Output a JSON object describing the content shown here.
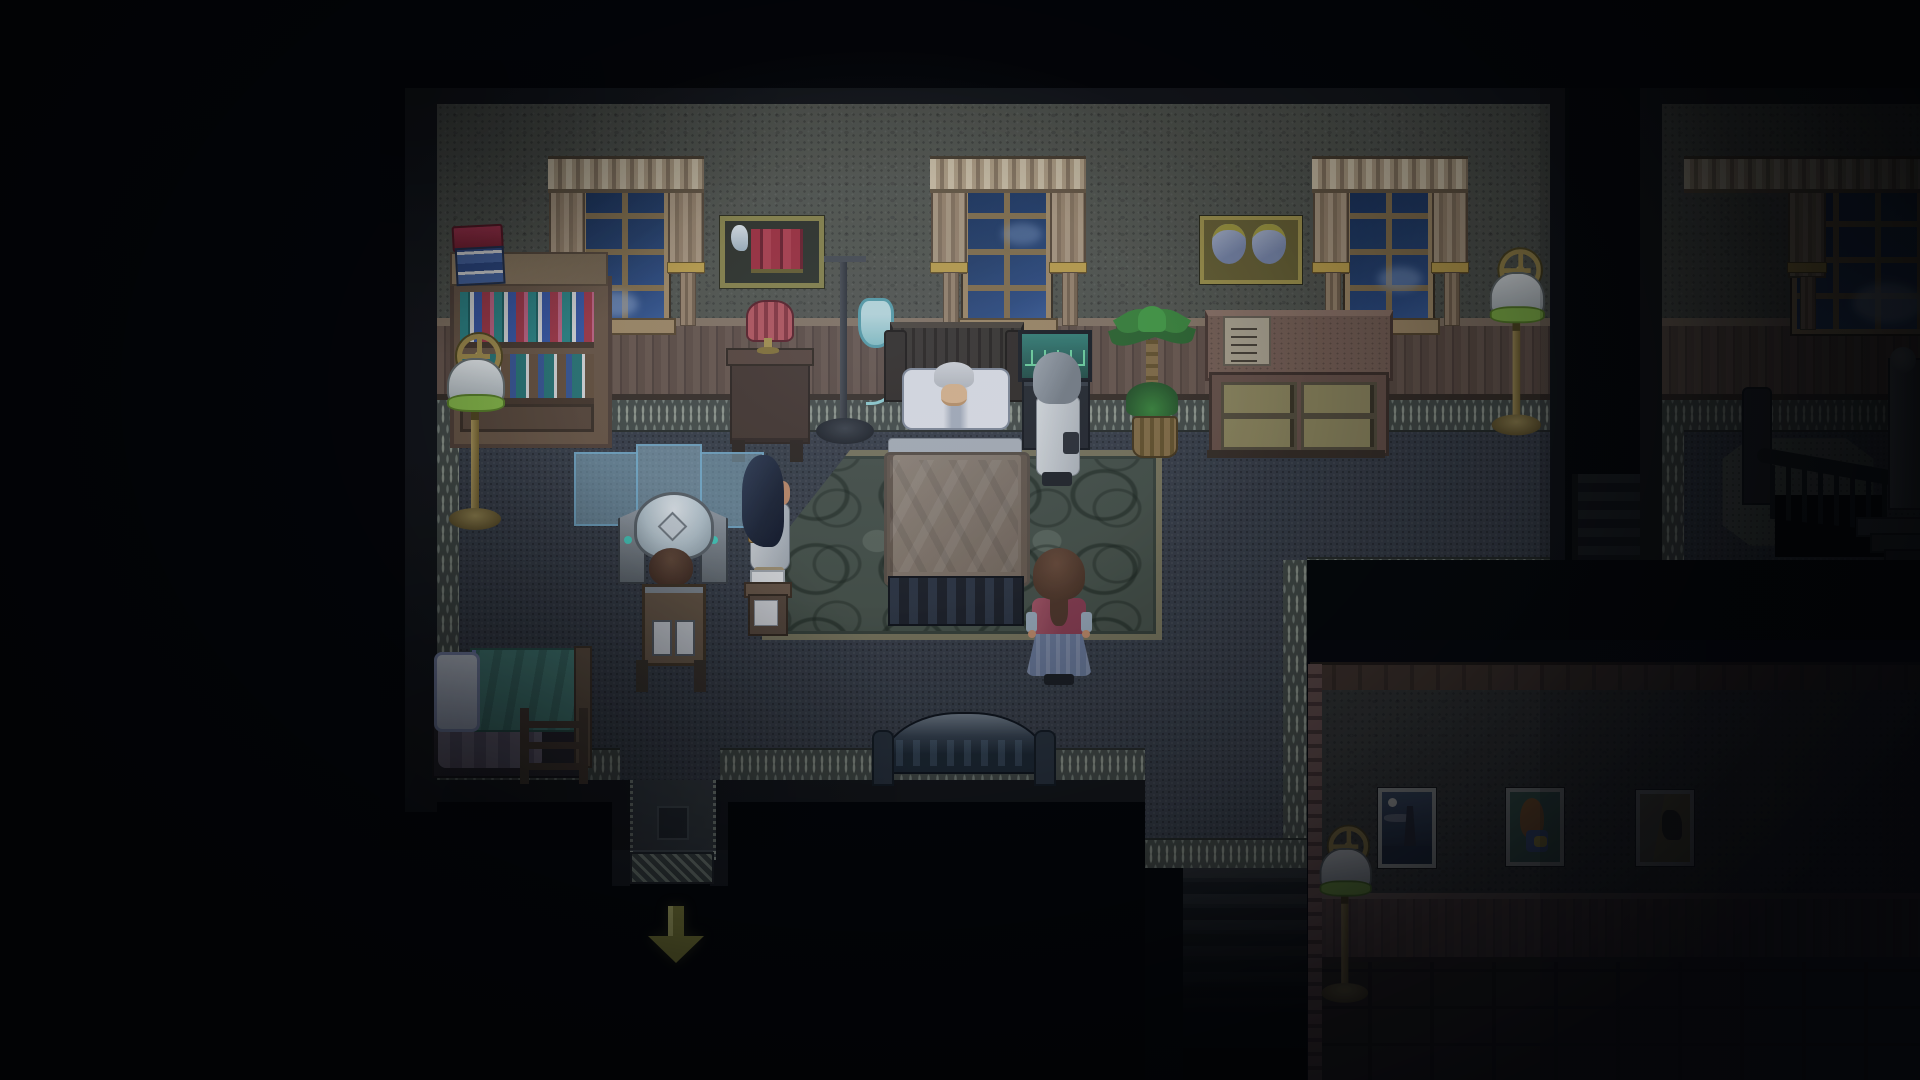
{
  "meta": {
    "domain": "game",
    "style": "16-bit pixel RPG interior",
    "time_of_day": "night",
    "ui_text_visible": false
  },
  "palette": {
    "background": "#030507",
    "stone_wall": "#565951",
    "wainscot": "#6e5b50",
    "floor": "#3b414b",
    "floor_border_dots": "#98a094",
    "window_glass": "#24406e",
    "window_frame": "#a8906a",
    "curtain": "#b4a086",
    "rug_green": "#49544b",
    "lamp_shade": "#f0f4f5",
    "lamp_rim_green": "#8cc04a",
    "brass": "#9a8650",
    "blanket": "#8a7d70",
    "monitor_screen": "#2e6a64",
    "monitor_wave": "#74e0a8",
    "iv_bag": "#8ecfd4",
    "red_lamp": "#b85058",
    "exit_arrow_olive": "#8a8a3c",
    "hall_wainscot": "#72594f"
  },
  "scene": {
    "rooms": [
      {
        "id": "bedroom",
        "label": "main bedroom with three windows",
        "window_count": 3
      },
      {
        "id": "landing",
        "label": "stair landing room with one window and spiral staircase",
        "window_count": 1
      },
      {
        "id": "hallway",
        "label": "lower hallway with three paintings",
        "painting_count": 3
      }
    ],
    "characters": [
      {
        "id": "patient",
        "label": "elderly patient with white hair lying in the sickbed",
        "hair": "white"
      },
      {
        "id": "woman_white_dress",
        "label": "woman with long dark navy hair in a white dress standing left of the bed",
        "hair": "dark navy"
      },
      {
        "id": "caretaker",
        "label": "grey haired person in a white coat standing right of the bed",
        "hair": "grey"
      },
      {
        "id": "girl",
        "label": "brown haired girl in dark pink top and long blue skirt facing the bed",
        "hair": "brown"
      },
      {
        "id": "operator",
        "label": "brown haired person seated at the memory machine",
        "hair": "brown"
      }
    ],
    "furniture": [
      {
        "id": "sickbed",
        "label": "dark wooden sickbed with white pillows and brown blanket"
      },
      {
        "id": "iv_stand",
        "label": "IV drip stand with teal fluid bag"
      },
      {
        "id": "heart_monitor",
        "label": "bedside monitor with teal screen and green trace"
      },
      {
        "id": "memory_machine",
        "label": "helmeted memory machine with operator seat"
      },
      {
        "id": "folding_screen",
        "label": "translucent blue three panel folding screen"
      },
      {
        "id": "bookshelf",
        "label": "wooden bookshelf with teal, white, blue, red and pink books"
      },
      {
        "id": "book_stack",
        "label": "stack of red and blue books on top of the bookshelf"
      },
      {
        "id": "wall_shelf_books",
        "label": "wall shelf with red books and white figurine"
      },
      {
        "id": "wall_shelf_jars",
        "label": "wall shelf with two blue jars with gold lids"
      },
      {
        "id": "nightstand_red_lamp",
        "label": "dark nightstand with striped red lamp"
      },
      {
        "id": "dresser",
        "label": "large dresser with four drawers and pinned note"
      },
      {
        "id": "palm_plant",
        "label": "potted palm plant in wicker basket"
      },
      {
        "id": "green_rug",
        "label": "large green rug with circle pattern under the bed"
      },
      {
        "id": "floor_lamp",
        "label": "brass floor lamp with green trimmed white shade and gear finial",
        "count": 3
      },
      {
        "id": "single_bed",
        "label": "single bed with teal blanket, pillow and step ladder"
      },
      {
        "id": "side_table",
        "label": "small side table with white book"
      },
      {
        "id": "couch",
        "label": "high backed couch seen from behind at the south wall"
      },
      {
        "id": "grey_rug",
        "label": "grey stepped-diamond rug on the landing"
      },
      {
        "id": "spiral_staircase",
        "label": "dark spiral staircase with grey newel post"
      },
      {
        "id": "hall_stairs",
        "label": "stairs descending toward the lower hallway"
      }
    ],
    "paintings": [
      {
        "id": "painting_lighthouse",
        "label": "night seascape with moon and lighthouse"
      },
      {
        "id": "painting_girl",
        "label": "portrait of a girl with long orange hair on teal background"
      },
      {
        "id": "painting_dark_figure",
        "label": "olive toned painting with dark figure"
      }
    ],
    "indicators": [
      {
        "id": "exit_arrow",
        "label": "olive green arrow pointing down at the south exit",
        "direction": "down"
      }
    ]
  }
}
